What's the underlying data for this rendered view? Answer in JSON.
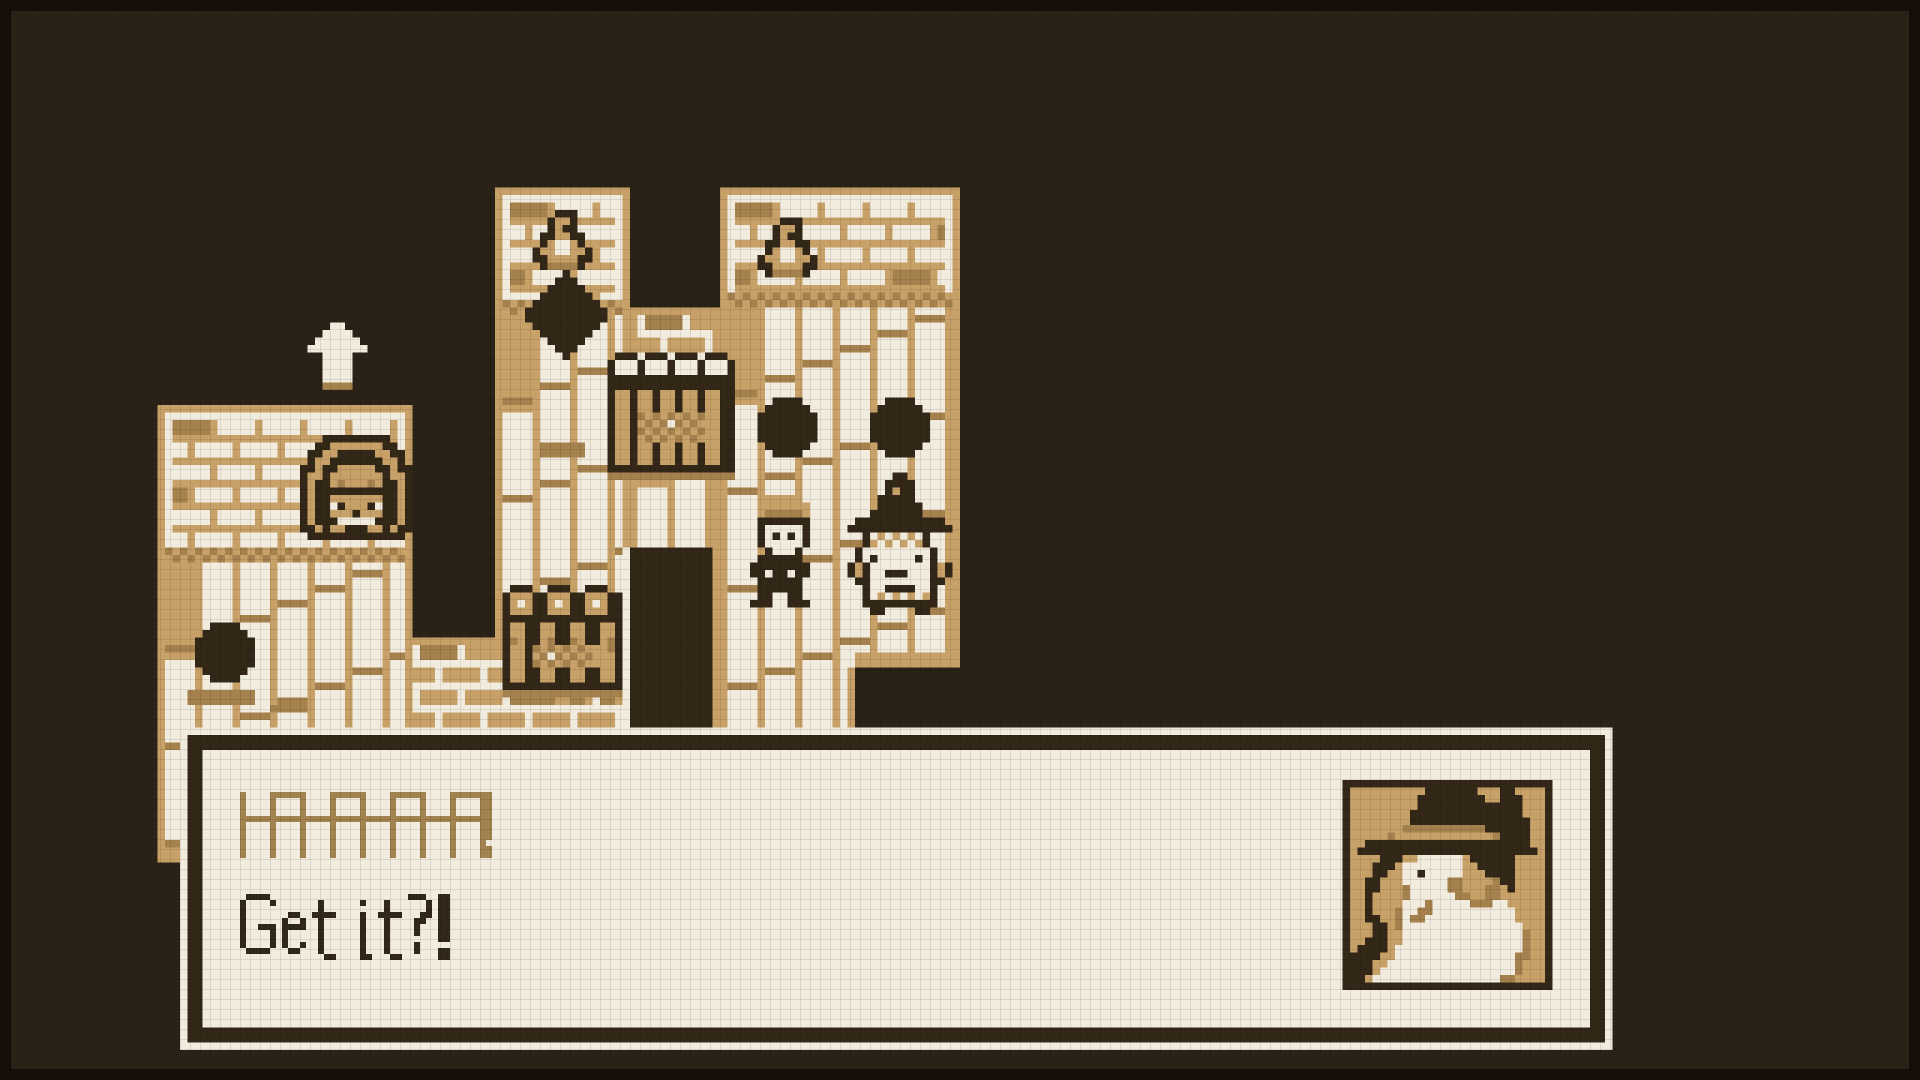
{
  "palette": {
    "BG": "#2b2217",
    "T": "#c8a168",
    "S": "#a5814e",
    "C": "#f2ecdf",
    "D": "#332818"
  },
  "dialog": {
    "line1": "HAHAHAHA!",
    "line2": "Get it?!",
    "line1_color": "#a2824e",
    "line2_color": "#32281a",
    "box_color": "#f3ede1",
    "frame_color": "#33291b"
  },
  "font": {
    "px": 6,
    "height": 11,
    "glyphs": {
      "H": [
        "X....X",
        "X....X",
        "X....X",
        "X....X",
        "XXXXXX",
        "X....X",
        "X....X",
        "X....X",
        "X....X",
        "X....X",
        "X....X"
      ],
      "A": [
        ".XXXX.",
        "X....X",
        "X....X",
        "X....X",
        "XXXXXX",
        "X....X",
        "X....X",
        "X....X",
        "X....X",
        "X....X",
        "X....X"
      ],
      "!": [
        "XX",
        "XX",
        "XX",
        "XX",
        "XX",
        "XX",
        "XX",
        "XX",
        "..",
        "XX",
        "XX"
      ],
      "G": [
        ".XXXX.",
        "X....X",
        "X.....",
        "X.....",
        "X.....",
        "X..XXX",
        "X....X",
        "X....X",
        "X....X",
        ".XXXX.",
        "......"
      ],
      "e": [
        "....",
        "....",
        "....",
        ".XX.",
        "X..X",
        "XXXX",
        "X...",
        "X...",
        "X..X",
        ".XX.",
        "...."
      ],
      "t": [
        "....",
        ".X..",
        ".X..",
        "XXXX",
        ".X..",
        ".X..",
        ".X..",
        ".X..",
        ".X..",
        ".X..",
        "..XX"
      ],
      "i": [
        "..",
        "X.",
        "..",
        "X.",
        "X.",
        "X.",
        "X.",
        "X.",
        "X.",
        "X.",
        "XX"
      ],
      "?": [
        "XXX.",
        "...X",
        "...X",
        "..XX",
        ".XX.",
        ".X..",
        ".X..",
        "....",
        ".X..",
        ".X..",
        "...."
      ],
      " ": [
        "..",
        "..",
        "..",
        "..",
        "..",
        "..",
        "..",
        "..",
        "..",
        "..",
        ".."
      ]
    }
  },
  "text_lines": [
    {
      "source": "line1",
      "x": 40,
      "y": 132,
      "tracking": -1,
      "color_key": "line1_color"
    },
    {
      "source": "line2",
      "x": 40,
      "y": 149,
      "tracking": 1,
      "color_key": "line2_color"
    }
  ],
  "scene": {
    "unit": 7.5,
    "w": 256,
    "h": 144,
    "rects": [
      {
        "n": "left-building-frame",
        "p": "T",
        "r": [
          21,
          54,
          34,
          61
        ]
      },
      {
        "n": "left-building-wall",
        "p": "C",
        "r": [
          22,
          55,
          32,
          58
        ]
      },
      {
        "n": "left-building-brick",
        "p": "brickTan",
        "r": [
          22,
          56,
          32,
          17
        ]
      },
      {
        "n": "left-building-checker",
        "p": "checker",
        "r": [
          22,
          73,
          32,
          2
        ]
      },
      {
        "n": "left-building-planks",
        "p": "plank",
        "r": [
          22,
          75,
          32,
          38
        ]
      },
      {
        "n": "left-building-base",
        "p": "T",
        "r": [
          21,
          113,
          34,
          2
        ]
      },
      {
        "n": "mid-tower-frame",
        "p": "T",
        "r": [
          66,
          25,
          18,
          61
        ]
      },
      {
        "n": "mid-tower-wall",
        "p": "C",
        "r": [
          67,
          26,
          16,
          59
        ]
      },
      {
        "n": "mid-tower-brick",
        "p": "brickTan",
        "r": [
          67,
          27,
          16,
          13
        ]
      },
      {
        "n": "mid-tower-checker",
        "p": "checker",
        "r": [
          67,
          40,
          16,
          2
        ]
      },
      {
        "n": "mid-tower-planks",
        "p": "plank",
        "r": [
          67,
          42,
          16,
          43
        ]
      },
      {
        "n": "connector-frame",
        "p": "T",
        "r": [
          84,
          41,
          12,
          56
        ]
      },
      {
        "n": "connector-wall",
        "p": "C",
        "r": [
          85,
          42,
          10,
          55
        ]
      },
      {
        "n": "connector-brick",
        "p": "brickCream",
        "r": [
          85,
          42,
          10,
          10
        ]
      },
      {
        "n": "connector-planks",
        "p": "plank",
        "r": [
          85,
          52,
          10,
          45
        ]
      },
      {
        "n": "right-tower-frame",
        "p": "T",
        "r": [
          96,
          25,
          32,
          72
        ]
      },
      {
        "n": "right-tower-wall",
        "p": "C",
        "r": [
          97,
          26,
          30,
          70
        ]
      },
      {
        "n": "right-tower-brick",
        "p": "brickTan",
        "r": [
          97,
          27,
          30,
          12
        ]
      },
      {
        "n": "right-tower-checker",
        "p": "checker",
        "r": [
          97,
          39,
          30,
          2
        ]
      },
      {
        "n": "right-tower-planks",
        "p": "plank",
        "r": [
          97,
          41,
          30,
          56
        ]
      },
      {
        "n": "right-tower-cut-border",
        "p": "T",
        "r": [
          114,
          87,
          14,
          2
        ]
      },
      {
        "n": "right-tower-cut",
        "p": "BG",
        "r": [
          114,
          89,
          14,
          8
        ]
      },
      {
        "n": "right-tower-cut-edge",
        "p": "T",
        "r": [
          113,
          89,
          1,
          8
        ]
      },
      {
        "n": "low-wall-border",
        "p": "T",
        "r": [
          55,
          85,
          29,
          1
        ]
      },
      {
        "n": "low-wall-brick",
        "p": "brickCream",
        "r": [
          55,
          86,
          29,
          11
        ]
      },
      {
        "n": "doorway-frame-left",
        "p": "C",
        "r": [
          83,
          73,
          1,
          24
        ]
      },
      {
        "n": "doorway-dark",
        "p": "D",
        "r": [
          84,
          73,
          11,
          24
        ]
      },
      {
        "n": "doorway-frame-right",
        "p": "T",
        "r": [
          95,
          73,
          1,
          24
        ]
      },
      {
        "n": "shadow-smudge-left",
        "p": "S",
        "r": [
          25,
          92,
          9,
          2
        ]
      },
      {
        "n": "shadow-smudge-left2",
        "p": "S",
        "r": [
          36,
          94,
          5,
          1
        ]
      },
      {
        "n": "shadow-smudge-mid",
        "p": "S",
        "r": [
          72,
          59,
          6,
          2
        ]
      }
    ],
    "dialog_rects": [
      {
        "n": "dialog-outer",
        "p": "C",
        "r": [
          24,
          97,
          191,
          43
        ]
      },
      {
        "n": "dialog-border",
        "p": "D",
        "r": [
          25,
          98,
          189,
          41
        ]
      },
      {
        "n": "dialog-interior",
        "p": "C",
        "r": [
          27,
          100,
          185,
          37
        ]
      },
      {
        "n": "portrait-frame",
        "p": "D",
        "r": [
          179,
          104,
          28,
          28
        ]
      }
    ],
    "sprites": {
      "door": [
        "...DDDDDDDDD...",
        "..DDTTTTTTTDD..",
        ".DDTTDDDDDTTDD.",
        ".DTTDDDDDDDTTD.",
        "DDTDDTTTTTDDTDD",
        "DTTDTTTTTTTDTTD",
        "DTDDTSTTTSTDDTD",
        "DTDDDDDDDDDDDTD",
        "DTDDTTTTTTTDDTD",
        "DTDDCDTTTDCDDTD",
        "DTDDTTTDTTTDDTD",
        "DTDDDCCCCCDDDTD",
        "DDTDTTDDDTTDTDD",
        ".DDDDDDDDDDDDD."
      ],
      "hole": [
        "..DDDD..",
        ".DDDDDD.",
        "DDDDDDDD",
        "DDDDDDDD",
        "DDDDDDDD",
        "DDDDDDDD",
        ".DDDDDD.",
        "..DDDD.."
      ],
      "bird": [
        "...DDD..",
        "..DTTD..",
        "..DTDD..",
        ".DDTTDD.",
        ".DTCCTD.",
        "DTTCCTTD",
        "DDTTTTDD",
        ".DSSSSD."
      ],
      "diamond": [
        ".....D.....",
        "....DDD....",
        "...DDDDD...",
        "..DDDDDDD..",
        ".DDDDDDDDD.",
        "DDDDDDDDDDD",
        "DDDDDDDDDDD",
        ".DDDDDDDDD.",
        "..DDDDDDD..",
        "...DDDDD...",
        "....DDD....",
        ".....D....."
      ],
      "arrow": [
        "...CC...",
        "..CCCC..",
        ".CCCCCC.",
        "CCCCCCCC",
        "..CCCC..",
        "..CCCC..",
        "..CCCC..",
        "..CCCC..",
        "..SSSS.."
      ],
      "jailUpper": [
        ".DDD.DDD.DDD.DDD.",
        "DCCCDCCCDCCCDCCCD",
        "DCCCDCCCDCCCDCCCD",
        "DDDDDDDDDDDDDDDDD",
        "DDDDDDDDDDDDDDDDD",
        "DTTDTTDTTDTTDTTDD",
        "DTTDTTDTTDTTDTTDD",
        "DTTDTTDTTDTTDTTDD",
        "DTTDSTSTSTSTSTTDD",
        "DTTDTSTSCSTSTTTDD",
        "DTTDSTSTSTSTSTTDD",
        "DTTDTSTSTSTSTTTDD",
        "DTTDTTDTTDTTDTTDD",
        "DTTDTTDTTDTTDTTDD",
        "DTTDTTDTTDTTDTTDD",
        "DDDDDDDDDDDDDDDDD",
        "SSSSSSSSSSSSSSSSS"
      ],
      "jailLower": [
        ".DDD..DDD..DDD..",
        "DTTTDDTTTDDTTTDD",
        "DTCTDDTCTDDTCTDD",
        "DTTTDDTTTDDTTTDD",
        "DDDDDDDDDDDDDDDD",
        "DTTDDTTDDTTDDTTD",
        "DTTDDTTDDTTDDTTD",
        "DSTDDTSDDSTDDTSD",
        "DTTDSTSTSTSTTTSD",
        "DTTDTSCSTSTSTTTD",
        "DTTDSTSTSTSTTTTD",
        "DTTDDTTDDTTDDTTD",
        "DTTDDTTDDTTDDTTD",
        "DDDDDDDDDDDDDDDD",
        "SSSSSSSSSSSSSSSS",
        ".SS..SS..SS..SS."
      ],
      "man": [
        "..TTTTT..",
        ".TTTTTTT.",
        ".TSSSSST.",
        ".DDDDDDD.",
        ".DCCCCCD.",
        ".DCDCDCD.",
        ".DCCCCCD.",
        "..DCCCD..",
        ".DDDDDD..",
        "DDDDDDDD.",
        "DDCDDCDD.",
        ".DDDDDD..",
        ".DDDDDD..",
        ".DD..DD..",
        "DDD..DDD."
      ],
      "witch": [
        "......DD......",
        ".....DDDD.....",
        ".....DTDD.....",
        "....DDDDD.....",
        "....DDDDDD....",
        "...DDDDDDD....",
        ".DDDDDDDDDDDD.",
        "DDDDDDDDDDDDDD",
        "..DCTCTCTCD...",
        "..DTCTCTCTD...",
        ".DCCCCCCCCCD..",
        ".DCDCCCCCDCD..",
        "DTDCCCCCCCCDTD",
        "DTDCCDDDCCCDTD",
        ".DDCCCCCCCCDD.",
        "..DCCDDDDCCD..",
        "..DCTCTCTCTD..",
        "..DDDDDDDDDD..",
        "...DD....DD..."
      ],
      "portrait": [
        "TTTTTTTTTTDDDDDDDTTTDDTTTT",
        "TTTTTTTTTDDDDDDDDDTTDDDTTT",
        "TTTTTTTTTDDDDDDDDDDDDDDTTT",
        "TTTTTTTTDDDDDDDDDDDDDDDTTT",
        "TTTTTTTTDDDDDDDDDDDDDDDDTT",
        "TTTTTTTSSSSSSSSSSSDDDDDDTT",
        "TTTTTSTTTTTTTTTTTTTSDDDDTT",
        "TTDDDDDDDDDDDDDDDDDDDDDDTT",
        "TDDDDDDDDDDDDDDDDDDDDDDDDT",
        "TTTTDDDTTCCCCCCTDDDDDDTTTT",
        "TTTDDDTCCCCCCCCTTDDDDDTTTT",
        "TTTDDTTCCDCCCCCTTTDDDDTTTT",
        "TTDDTTTCCCCCCSSTTTTSDDTTTT",
        "TTDDTTTSCCCCCSSTTTSSTDTTTT",
        "TTDTTTTSCCCCCCSSTTSSTTTTTT",
        "TTDTTTTCCCSCCCCCSSSCCTTTTT",
        "TTDTTTSCCSSCCCCCCCCCCCTTTT",
        "TTDDTTSCSSCCCCCCCCCCCCTTTT",
        "TTTDDTSCCCCCCCCCCCCCCCCTTT",
        "TTTDDTTCCCCCCCCCCCCCCCCSTT",
        "TTDDDTTCCCCCCCCCCCCCCCCSTT",
        "TDDDDTCCCCCCCCCCCCCCCCCSTT",
        "DDDDTTCCCCCCCCCCCCCCCCSSTT",
        "DDDTTCCCCCCCCCCCCCCCCCSTTT",
        "DDDTCCCCCCCCCCCCCCCCCCSTTT",
        "DDTCCCCCCCCCCCCCCCCCSSTTTT"
      ]
    },
    "placements": [
      {
        "n": "door-face",
        "s": "door",
        "x": 40,
        "y": 58
      },
      {
        "n": "hole-left",
        "s": "hole",
        "x": 26,
        "y": 83
      },
      {
        "n": "hole-right-1",
        "s": "hole",
        "x": 101,
        "y": 53
      },
      {
        "n": "hole-right-2",
        "s": "hole",
        "x": 116,
        "y": 53
      },
      {
        "n": "bird-mid-tower",
        "s": "bird",
        "x": 71,
        "y": 28
      },
      {
        "n": "bird-right-tower",
        "s": "bird",
        "x": 101,
        "y": 29
      },
      {
        "n": "diamond-marker",
        "s": "diamond",
        "x": 70,
        "y": 36
      },
      {
        "n": "cursor-arrow",
        "s": "arrow",
        "x": 41,
        "y": 43
      },
      {
        "n": "window-prisoners-top",
        "s": "jailUpper",
        "x": 81,
        "y": 47
      },
      {
        "n": "window-prisoners-low",
        "s": "jailLower",
        "x": 67,
        "y": 78
      },
      {
        "n": "npc-cap-man",
        "s": "man",
        "x": 100,
        "y": 66
      },
      {
        "n": "npc-witch",
        "s": "witch",
        "x": 113,
        "y": 63
      }
    ],
    "portrait_pos": {
      "x": 180,
      "y": 105
    },
    "hotspots": [
      {
        "n": "building-left",
        "x": 155,
        "y": 405,
        "w": 258,
        "h": 450,
        "i": false
      },
      {
        "n": "tower-middle",
        "x": 495,
        "y": 188,
        "w": 135,
        "h": 458,
        "i": false
      },
      {
        "n": "building-connector",
        "x": 630,
        "y": 308,
        "w": 90,
        "h": 420,
        "i": false
      },
      {
        "n": "tower-right",
        "x": 720,
        "y": 188,
        "w": 240,
        "h": 540,
        "i": false
      },
      {
        "n": "door-face",
        "x": 300,
        "y": 435,
        "w": 113,
        "h": 105,
        "i": false
      },
      {
        "n": "window-prisoners-upper",
        "x": 608,
        "y": 353,
        "w": 128,
        "h": 128,
        "i": false
      },
      {
        "n": "window-prisoners-lower",
        "x": 503,
        "y": 585,
        "w": 120,
        "h": 120,
        "i": false
      },
      {
        "n": "dark-doorway",
        "x": 623,
        "y": 548,
        "w": 100,
        "h": 180,
        "i": false
      },
      {
        "n": "hole-left",
        "x": 195,
        "y": 620,
        "w": 60,
        "h": 60,
        "i": false
      },
      {
        "n": "hole-right-1",
        "x": 755,
        "y": 396,
        "w": 62,
        "h": 62,
        "i": false
      },
      {
        "n": "hole-right-2",
        "x": 868,
        "y": 398,
        "w": 62,
        "h": 62,
        "i": false
      },
      {
        "n": "bird-mid-tower",
        "x": 533,
        "y": 210,
        "w": 58,
        "h": 62,
        "i": false
      },
      {
        "n": "bird-right-tower",
        "x": 758,
        "y": 218,
        "w": 56,
        "h": 58,
        "i": false
      },
      {
        "n": "diamond-marker",
        "x": 525,
        "y": 270,
        "w": 82,
        "h": 95,
        "i": false
      },
      {
        "n": "cursor-arrow",
        "x": 305,
        "y": 320,
        "w": 62,
        "h": 68,
        "i": false
      },
      {
        "n": "npc-cap-man",
        "x": 748,
        "y": 495,
        "w": 68,
        "h": 115,
        "i": false
      },
      {
        "n": "npc-witch",
        "x": 848,
        "y": 472,
        "w": 105,
        "h": 143,
        "i": false
      }
    ]
  }
}
